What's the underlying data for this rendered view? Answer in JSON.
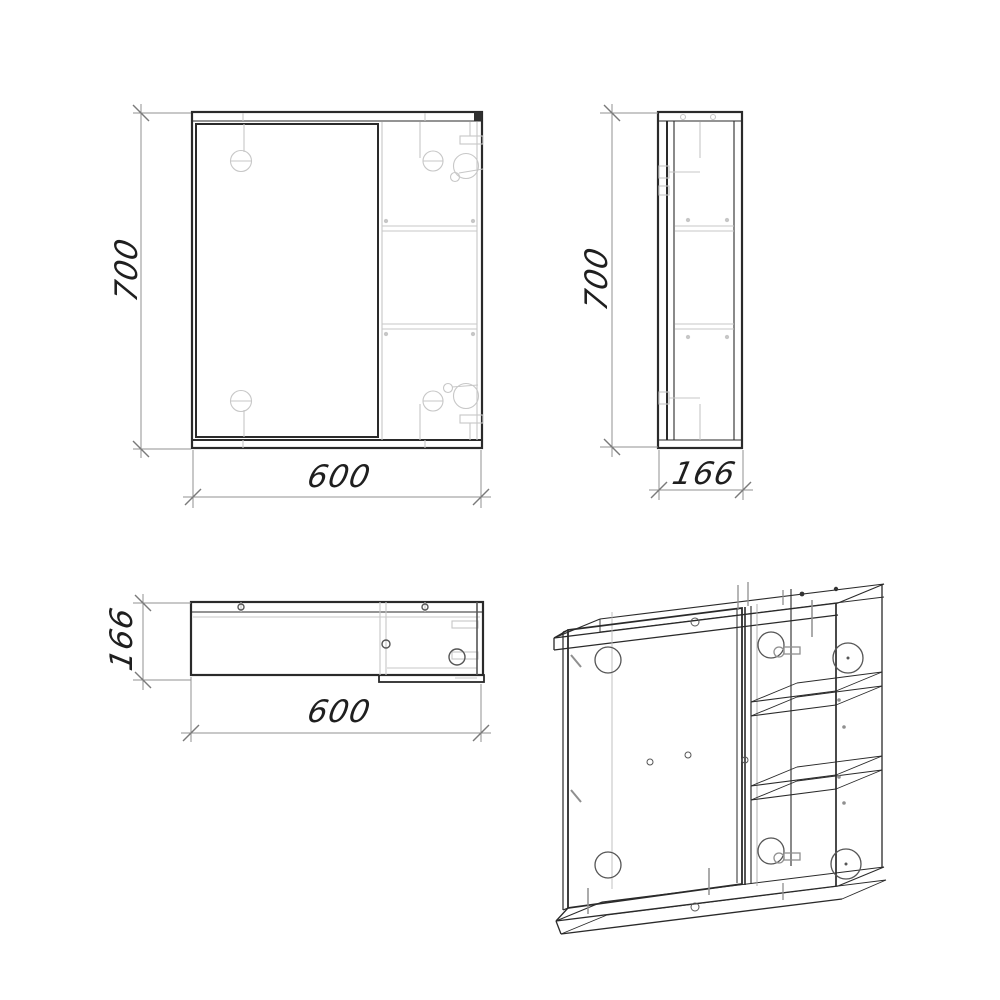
{
  "drawing": {
    "type": "furniture-technical-drawing",
    "subject": "mirror-cabinet-four-views",
    "colors": {
      "background": "#ffffff",
      "outline": "#2a2a2a",
      "detail_gray": "#c7c7c7",
      "fitting_gray": "#8f8f8f",
      "dimension_gray": "#909090",
      "text": "#1f1f1f"
    },
    "views": {
      "front": {
        "name": "front view",
        "height_dim": "700",
        "width_dim": "600"
      },
      "side": {
        "name": "side view",
        "height_dim": "700",
        "depth_dim": "166"
      },
      "top": {
        "name": "top view",
        "depth_dim": "166",
        "width_dim": "600"
      },
      "isometric": {
        "name": "isometric view"
      }
    }
  }
}
